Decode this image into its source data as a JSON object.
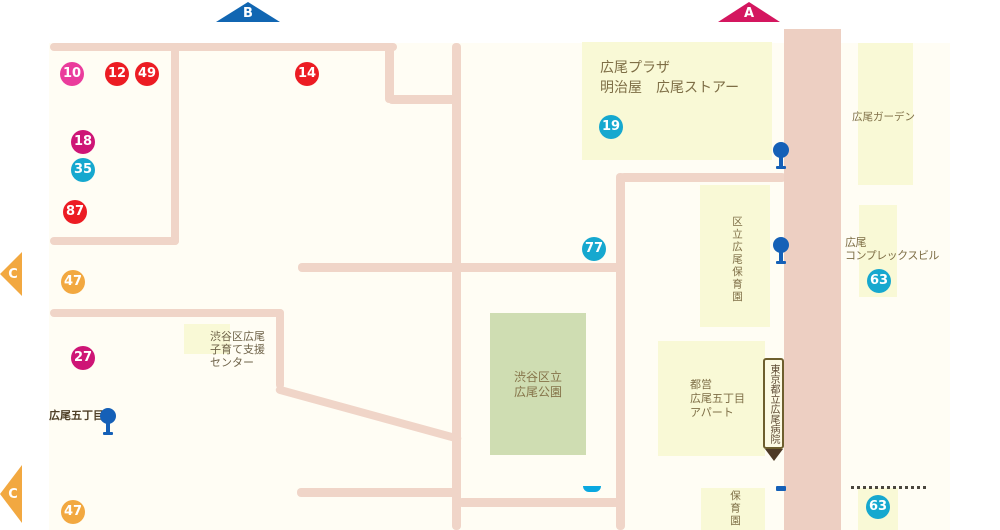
{
  "arrows": {
    "a_label": "A",
    "b_label": "B",
    "c_upper_label": "C",
    "c_lower_label": "C"
  },
  "stop_markers": [
    {
      "label": "10",
      "color": "#EA3C9C"
    },
    {
      "label": "12",
      "color": "#EC1C23"
    },
    {
      "label": "49",
      "color": "#EC1C23"
    },
    {
      "label": "14",
      "color": "#EC1C23"
    },
    {
      "label": "18",
      "color": "#CE1576"
    },
    {
      "label": "35",
      "color": "#16A8CF"
    },
    {
      "label": "87",
      "color": "#EC1C23"
    },
    {
      "label": "47",
      "color": "#F2A840"
    },
    {
      "label": "27",
      "color": "#CE1576"
    },
    {
      "label": "47",
      "color": "#F2A840"
    },
    {
      "label": "19",
      "color": "#16A8CF"
    },
    {
      "label": "77",
      "color": "#16A8CF"
    },
    {
      "label": "63",
      "color": "#16A8CF"
    },
    {
      "label": "63",
      "color": "#16A8CF"
    }
  ],
  "places": {
    "hiroo_plaza_line1": "広尾プラザ",
    "hiroo_plaza_line2": "明治屋　広尾ストアー",
    "hiroo_garden": "広尾ガーデン",
    "kuritsu_hoikuen": "区立広尾保育園",
    "hiroo_complex_line1": "広尾",
    "hiroo_complex_line2": "コンプレックスビル",
    "kosodate_line1": "渋谷区広尾",
    "kosodate_line2": "子育て支援",
    "kosodate_line3": "センター",
    "park_line1": "渋谷区立",
    "park_line2": "広尾公園",
    "toei_line1": "都営",
    "toei_line2": "広尾五丁目",
    "toei_line3": "アパート",
    "hoikuen_bottom": "保育園",
    "hospital_sign": "東京都立広尾病院",
    "street": "広尾五丁目"
  },
  "colors": {
    "map_background": "#FFFDF4",
    "road": "#F0D5C8",
    "main_road": "#EDCFC2",
    "building": "#F9F9D6",
    "park": "#CFDDB2",
    "marker_red": "#EC1C23",
    "marker_pink": "#EA3C9C",
    "marker_magenta": "#CE1576",
    "marker_cyan": "#16A8CF",
    "marker_orange": "#F2A840",
    "arrow_a": "#D4165F",
    "arrow_b": "#1166B2",
    "arrow_c": "#F2A840",
    "bus_pin_blue": "#1560B7",
    "label_text": "#7E6E46",
    "sign_border": "#6E5F2E"
  }
}
